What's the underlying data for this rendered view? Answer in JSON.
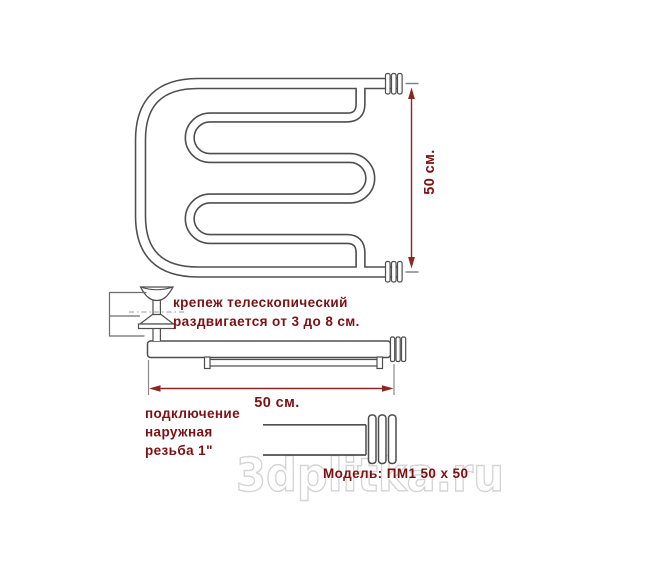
{
  "colors": {
    "accent": "#7a1113",
    "dim": "#8a2623",
    "line": "#4e4e4e",
    "watermark": "#d4d4d4"
  },
  "front_view": {
    "height_dimension": "50 см."
  },
  "side_view": {
    "fastener_note_line1": "крепеж телескопический",
    "fastener_note_line2": "раздвигается от 3 до 8 см.",
    "width_dimension": "50 см."
  },
  "connection_view": {
    "note_line1": "подключение",
    "note_line2": "наружная",
    "note_line3": "резьба 1\""
  },
  "model_label": "Модель: ПМ1 50 x 50",
  "watermark": "3dplitka.ru"
}
